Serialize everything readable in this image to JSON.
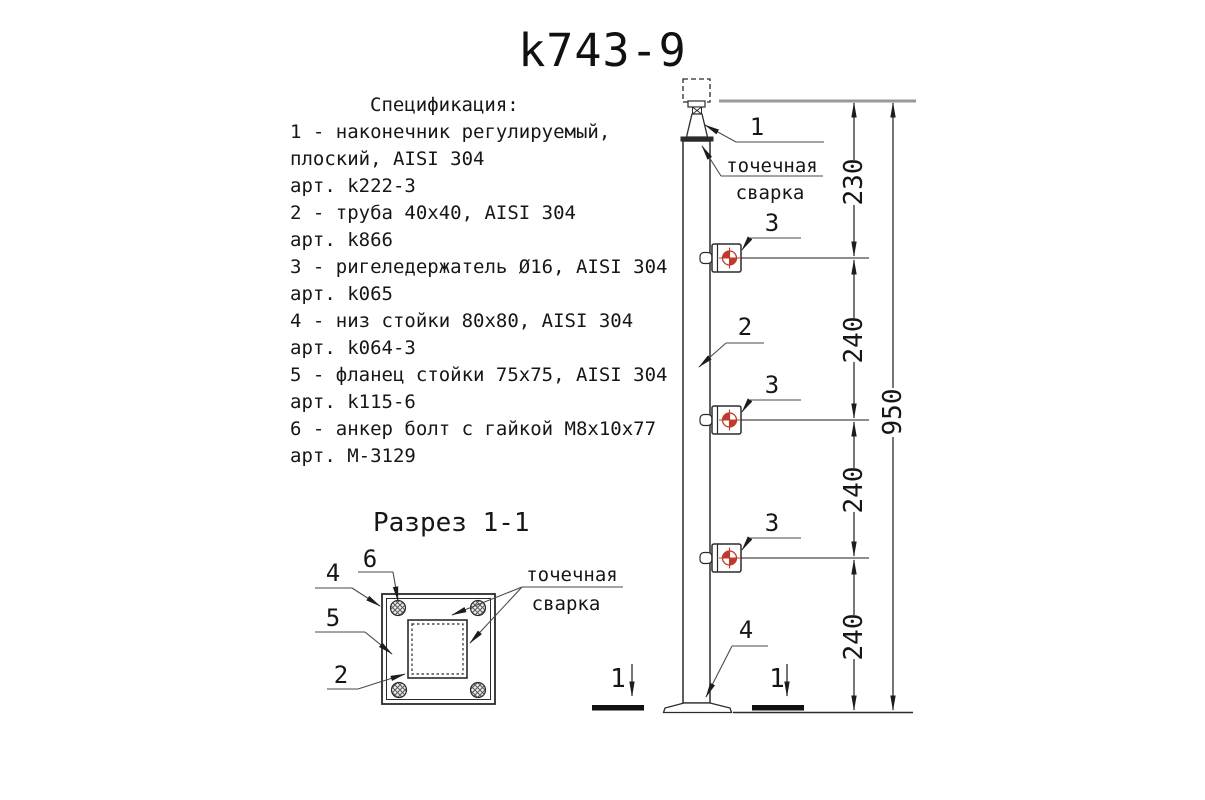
{
  "title": "k743-9",
  "spec": {
    "heading": "Спецификация:",
    "lines": [
      "1 - наконечник регулируемый,",
      "плоский, AISI 304",
      "арт. k222-3",
      "2 - труба 40х40, AISI 304",
      "арт. k866",
      "3 - ригеледержатель Ø16, AISI 304",
      "арт. k065",
      "4 - низ стойки 80х80, AISI 304",
      "арт. k064-3",
      "5 - фланец стойки 75х75, AISI 304",
      "арт. k115-6",
      "6 - анкер болт с гайкой М8х10х77",
      "арт. М-3129"
    ]
  },
  "section": {
    "title": "Разрез 1-1",
    "callout_4": "4",
    "callout_6": "6",
    "callout_5": "5",
    "callout_2": "2",
    "weld_line1": "точечная",
    "weld_line2": "сварка"
  },
  "column": {
    "callout_1": "1",
    "callout_2": "2",
    "callout_3": "3",
    "callout_4": "4",
    "weld_line1": "точечная",
    "weld_line2": "сварка",
    "section_mark_left": "1",
    "section_mark_right": "1"
  },
  "dimensions": {
    "seg_230": "230",
    "seg_240a": "240",
    "seg_240b": "240",
    "seg_240c": "240",
    "total_950": "950"
  },
  "colors": {
    "line": "#2b2b2b",
    "weld_target_red": "#c0392b"
  }
}
